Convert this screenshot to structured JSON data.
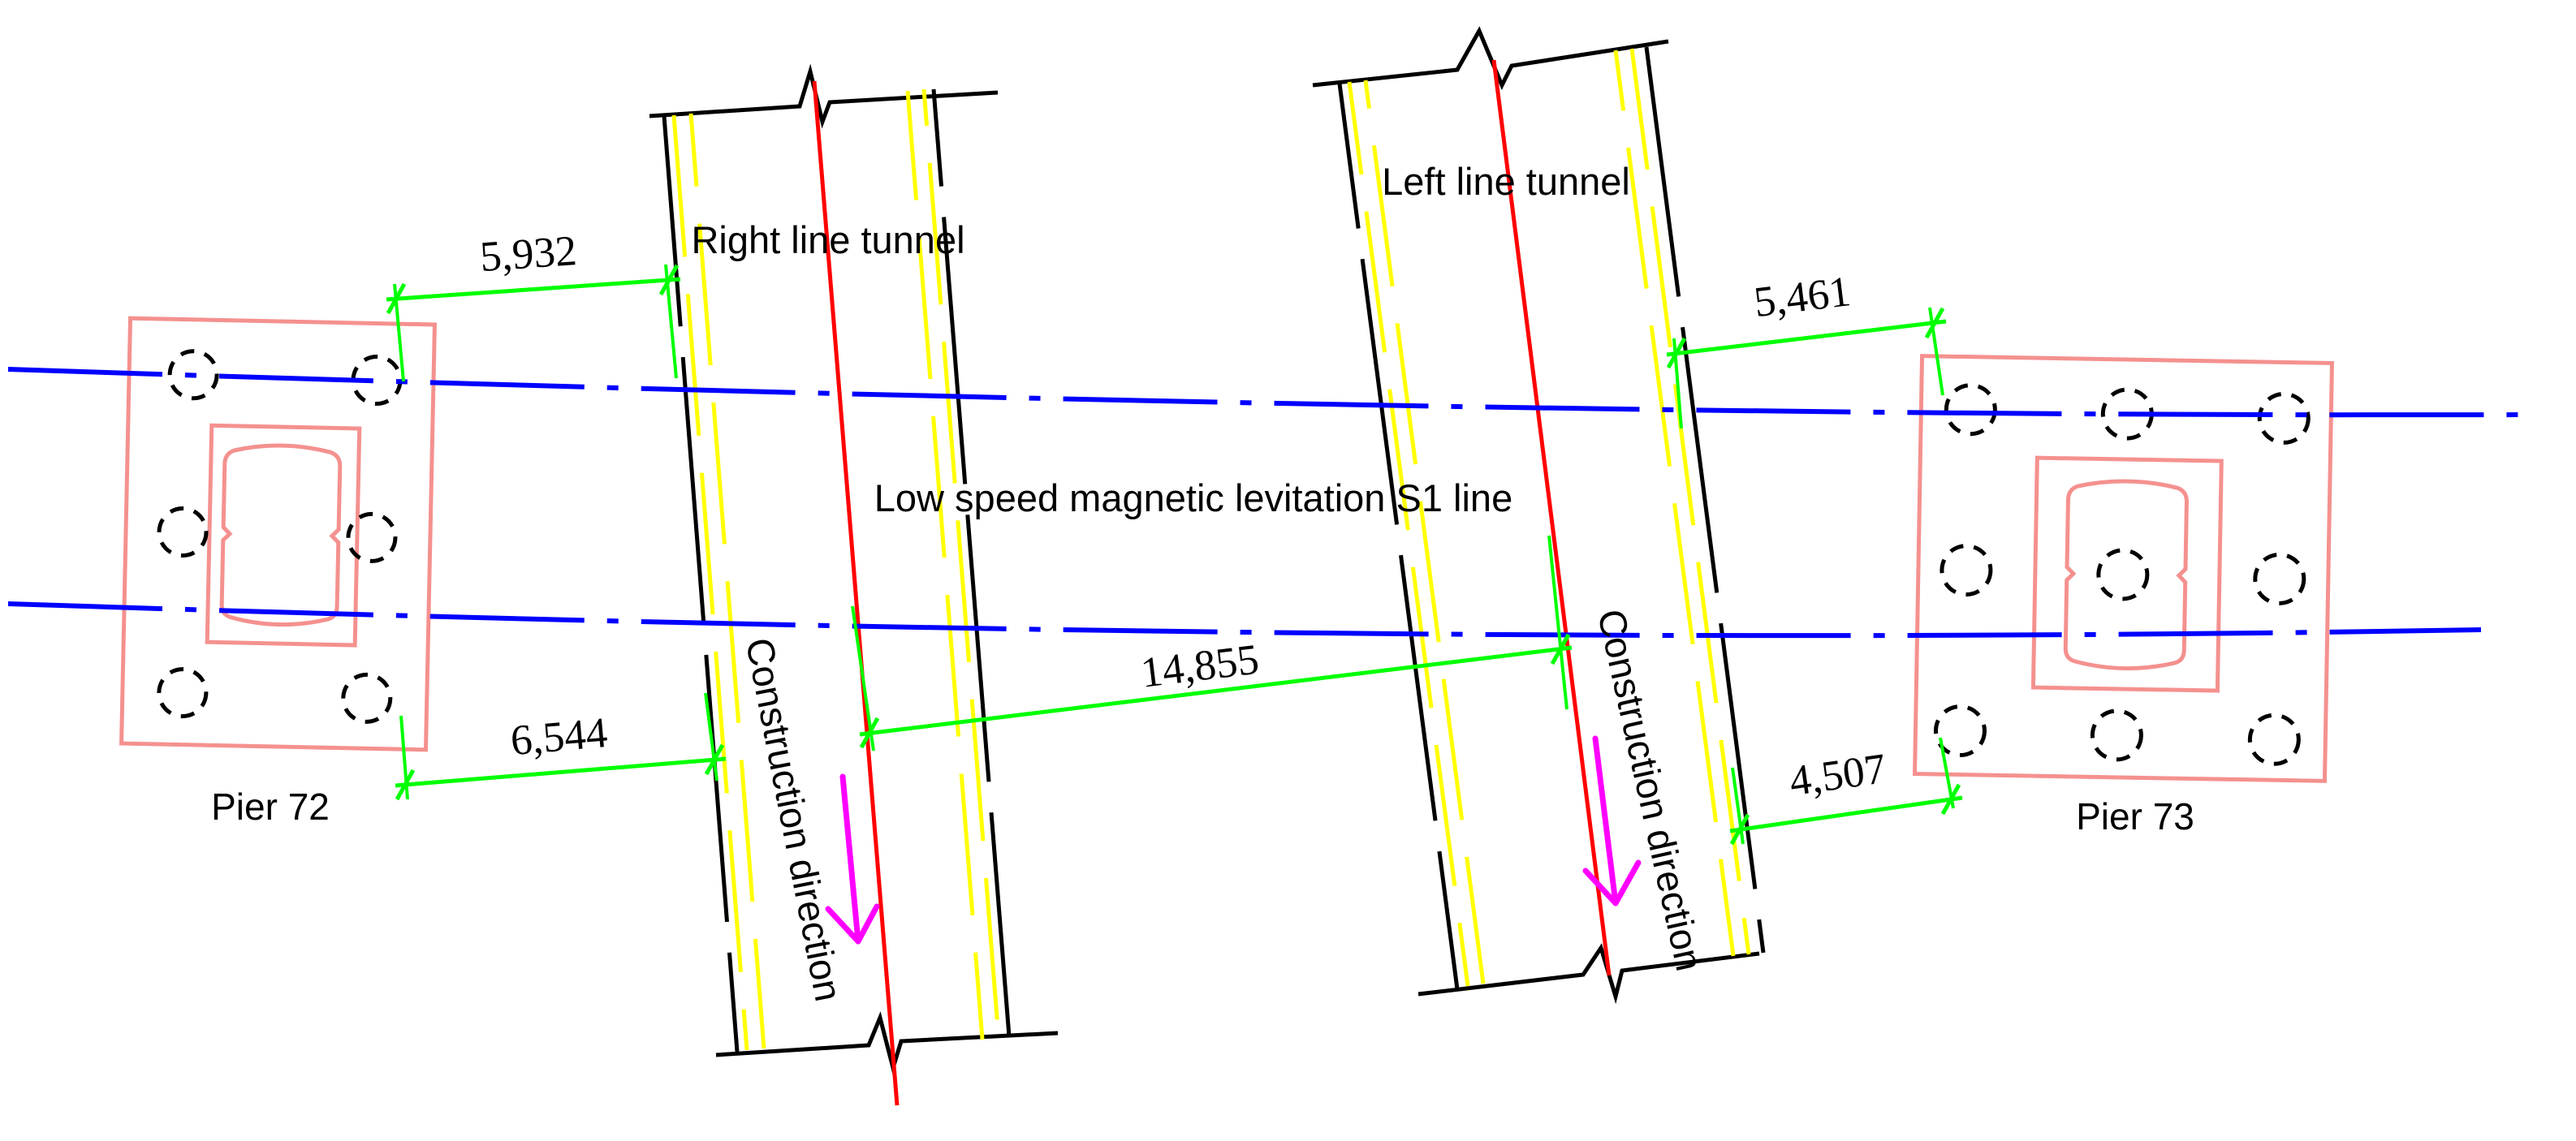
{
  "drawing": {
    "s1_line_label": "Low speed magnetic levitation S1 line",
    "tunnels": {
      "right": {
        "label": "Right line tunnel",
        "construction_direction": "Construction direction"
      },
      "left": {
        "label": "Left line tunnel",
        "construction_direction": "Construction direction"
      }
    },
    "piers": {
      "pier_72": {
        "label": "Pier 72"
      },
      "pier_73": {
        "label": "Pier 73"
      }
    },
    "dimensions": {
      "pier72_to_right_tunnel_upper": "5,932",
      "pier72_to_right_tunnel_lower": "6,544",
      "tunnel_centerline_spacing": "14,855",
      "left_tunnel_to_pier73_upper": "5,461",
      "left_tunnel_to_pier73_lower": "4,507"
    },
    "colors": {
      "tunnel_edge": "#000000",
      "track_guide": "#ffff00",
      "tunnel_centerline": "#ff0000",
      "alignment_axis": "#0000ff",
      "dimension": "#00ff00",
      "pier_outline": "#f4918f",
      "direction_arrow": "#ff00ff",
      "text": "#000000"
    }
  }
}
